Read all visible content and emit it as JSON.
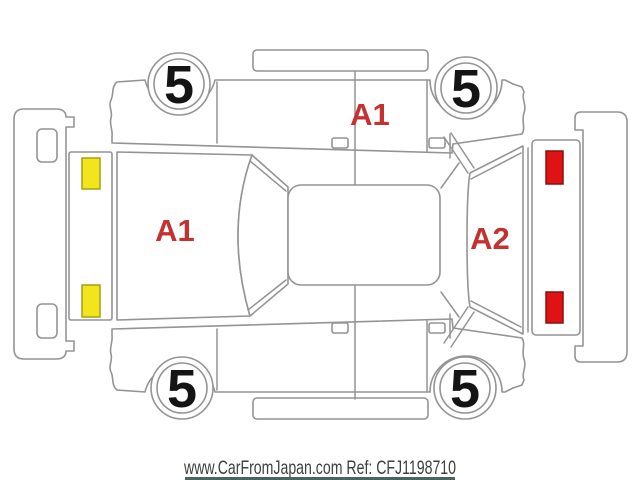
{
  "diagram": {
    "wheels": [
      {
        "position": "top-left",
        "grade": "5"
      },
      {
        "position": "top-right",
        "grade": "5"
      },
      {
        "position": "bottom-left",
        "grade": "5"
      },
      {
        "position": "bottom-right",
        "grade": "5"
      }
    ],
    "damage_markers": [
      {
        "area": "side-doors",
        "code": "A1"
      },
      {
        "area": "hood",
        "code": "A1"
      },
      {
        "area": "rear-gate",
        "code": "A2"
      }
    ],
    "colors": {
      "outline": "#949494",
      "headlight_fill": "#f2e41d",
      "headlight_stroke": "#a79f12",
      "taillight_fill": "#e01313",
      "taillight_stroke": "#8c0f0f",
      "damage_text": "#c43131",
      "wheel_text": "#141414"
    }
  },
  "footer": {
    "text": "www.CarFromJapan.com Ref: CFJ1198710",
    "text_color": "#3f3f3f",
    "cutoff_line_color": "#4b6362"
  }
}
